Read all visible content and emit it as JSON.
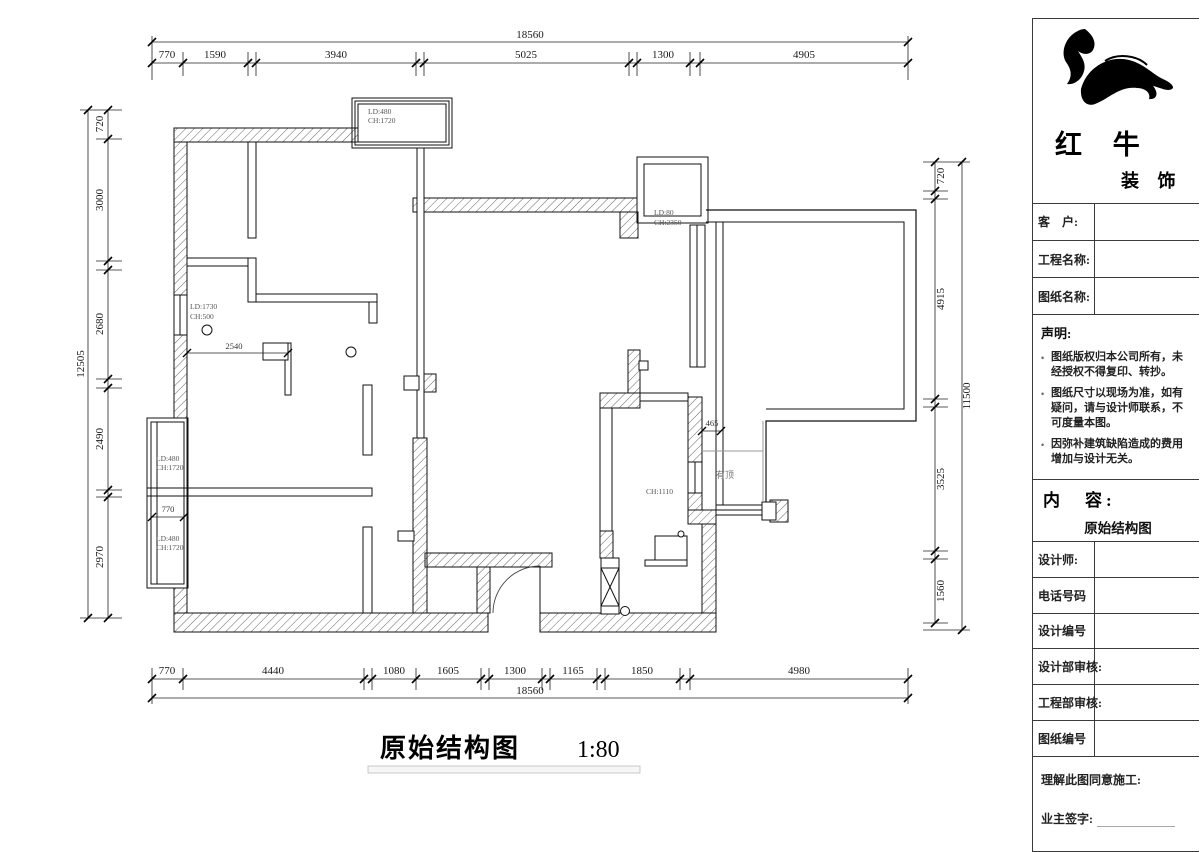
{
  "drawing": {
    "title": "原始结构图",
    "scale": "1:80",
    "dims": {
      "top_total": "18560",
      "top_segments": [
        "770",
        "1590",
        "3940",
        "5025",
        "1300",
        "4905"
      ],
      "bottom_segments": [
        "770",
        "4440",
        "1080",
        "1605",
        "1300",
        "1165",
        "1850",
        "4980"
      ],
      "bottom_total": "18560",
      "left_segments": [
        "720",
        "3000",
        "2680",
        "2490",
        "2970"
      ],
      "left_total": "12505",
      "right_segments": [
        "720",
        "4915",
        "3525",
        "1560"
      ],
      "right_total": "11500",
      "inner_2540": "2540",
      "inner_770": "770",
      "inner_465": "465"
    },
    "labels": {
      "window_top": [
        "LD:480",
        "CH:1720"
      ],
      "window_right": [
        "LD:80",
        "CH:2350"
      ],
      "window_left_high": [
        "LD:1730",
        "CH:500"
      ],
      "bay_upper": [
        "LD:480",
        "CH:1720"
      ],
      "bay_lower": [
        "LD:480",
        "CH:1720"
      ],
      "wall_height": "CH:1110",
      "covered_area": "有顶"
    }
  },
  "title_block": {
    "brand": {
      "name_main": "红 牛",
      "name_sub": "装 饰"
    },
    "fields_top": [
      {
        "label": "客　户:"
      },
      {
        "label": "工程名称:"
      },
      {
        "label": "图纸名称:"
      }
    ],
    "statement": {
      "title": "声明:",
      "items": [
        "图纸版权归本公司所有，未经授权不得复印、转抄。",
        "图纸尺寸以现场为准，如有疑问，请与设计师联系，不可度量本图。",
        "因弥补建筑缺陷造成的费用增加与设计无关。"
      ]
    },
    "content": {
      "label": "内　容:",
      "value": "原始结构图"
    },
    "fields_bottom": [
      {
        "label": "设计师:"
      },
      {
        "label": "电话号码"
      },
      {
        "label": "设计编号"
      },
      {
        "label": "设计部审核:"
      },
      {
        "label": "工程部审核:"
      },
      {
        "label": "图纸编号"
      }
    ],
    "signature": {
      "line1": "理解此图同意施工:",
      "line2": "业主签字:"
    }
  }
}
